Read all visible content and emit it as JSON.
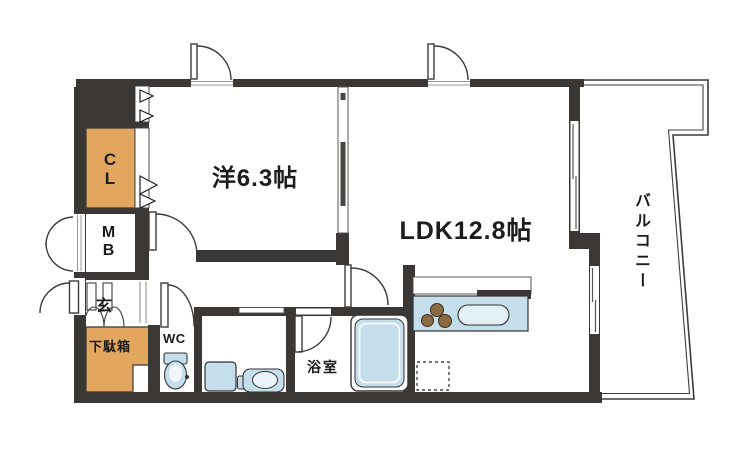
{
  "floor_plan": {
    "rooms": {
      "western_room": {
        "label": "洋6.3帖"
      },
      "ldk": {
        "label": "LDK12.8帖"
      },
      "balcony": {
        "label": "バルコニー"
      },
      "closet": {
        "label": "CL"
      },
      "meter_box": {
        "label": "MB"
      },
      "entrance": {
        "label": "玄"
      },
      "shoe_cabinet": {
        "label": "下駄箱"
      },
      "toilet": {
        "label": "WC"
      },
      "bathroom": {
        "label": "浴室"
      }
    },
    "colors": {
      "wall": "#3a3734",
      "storage_fill": "#e2a65e",
      "fixture_fill": "#c4deec",
      "line": "#3c3c3c",
      "burner": "#8a6b42",
      "background": "#ffffff"
    }
  }
}
